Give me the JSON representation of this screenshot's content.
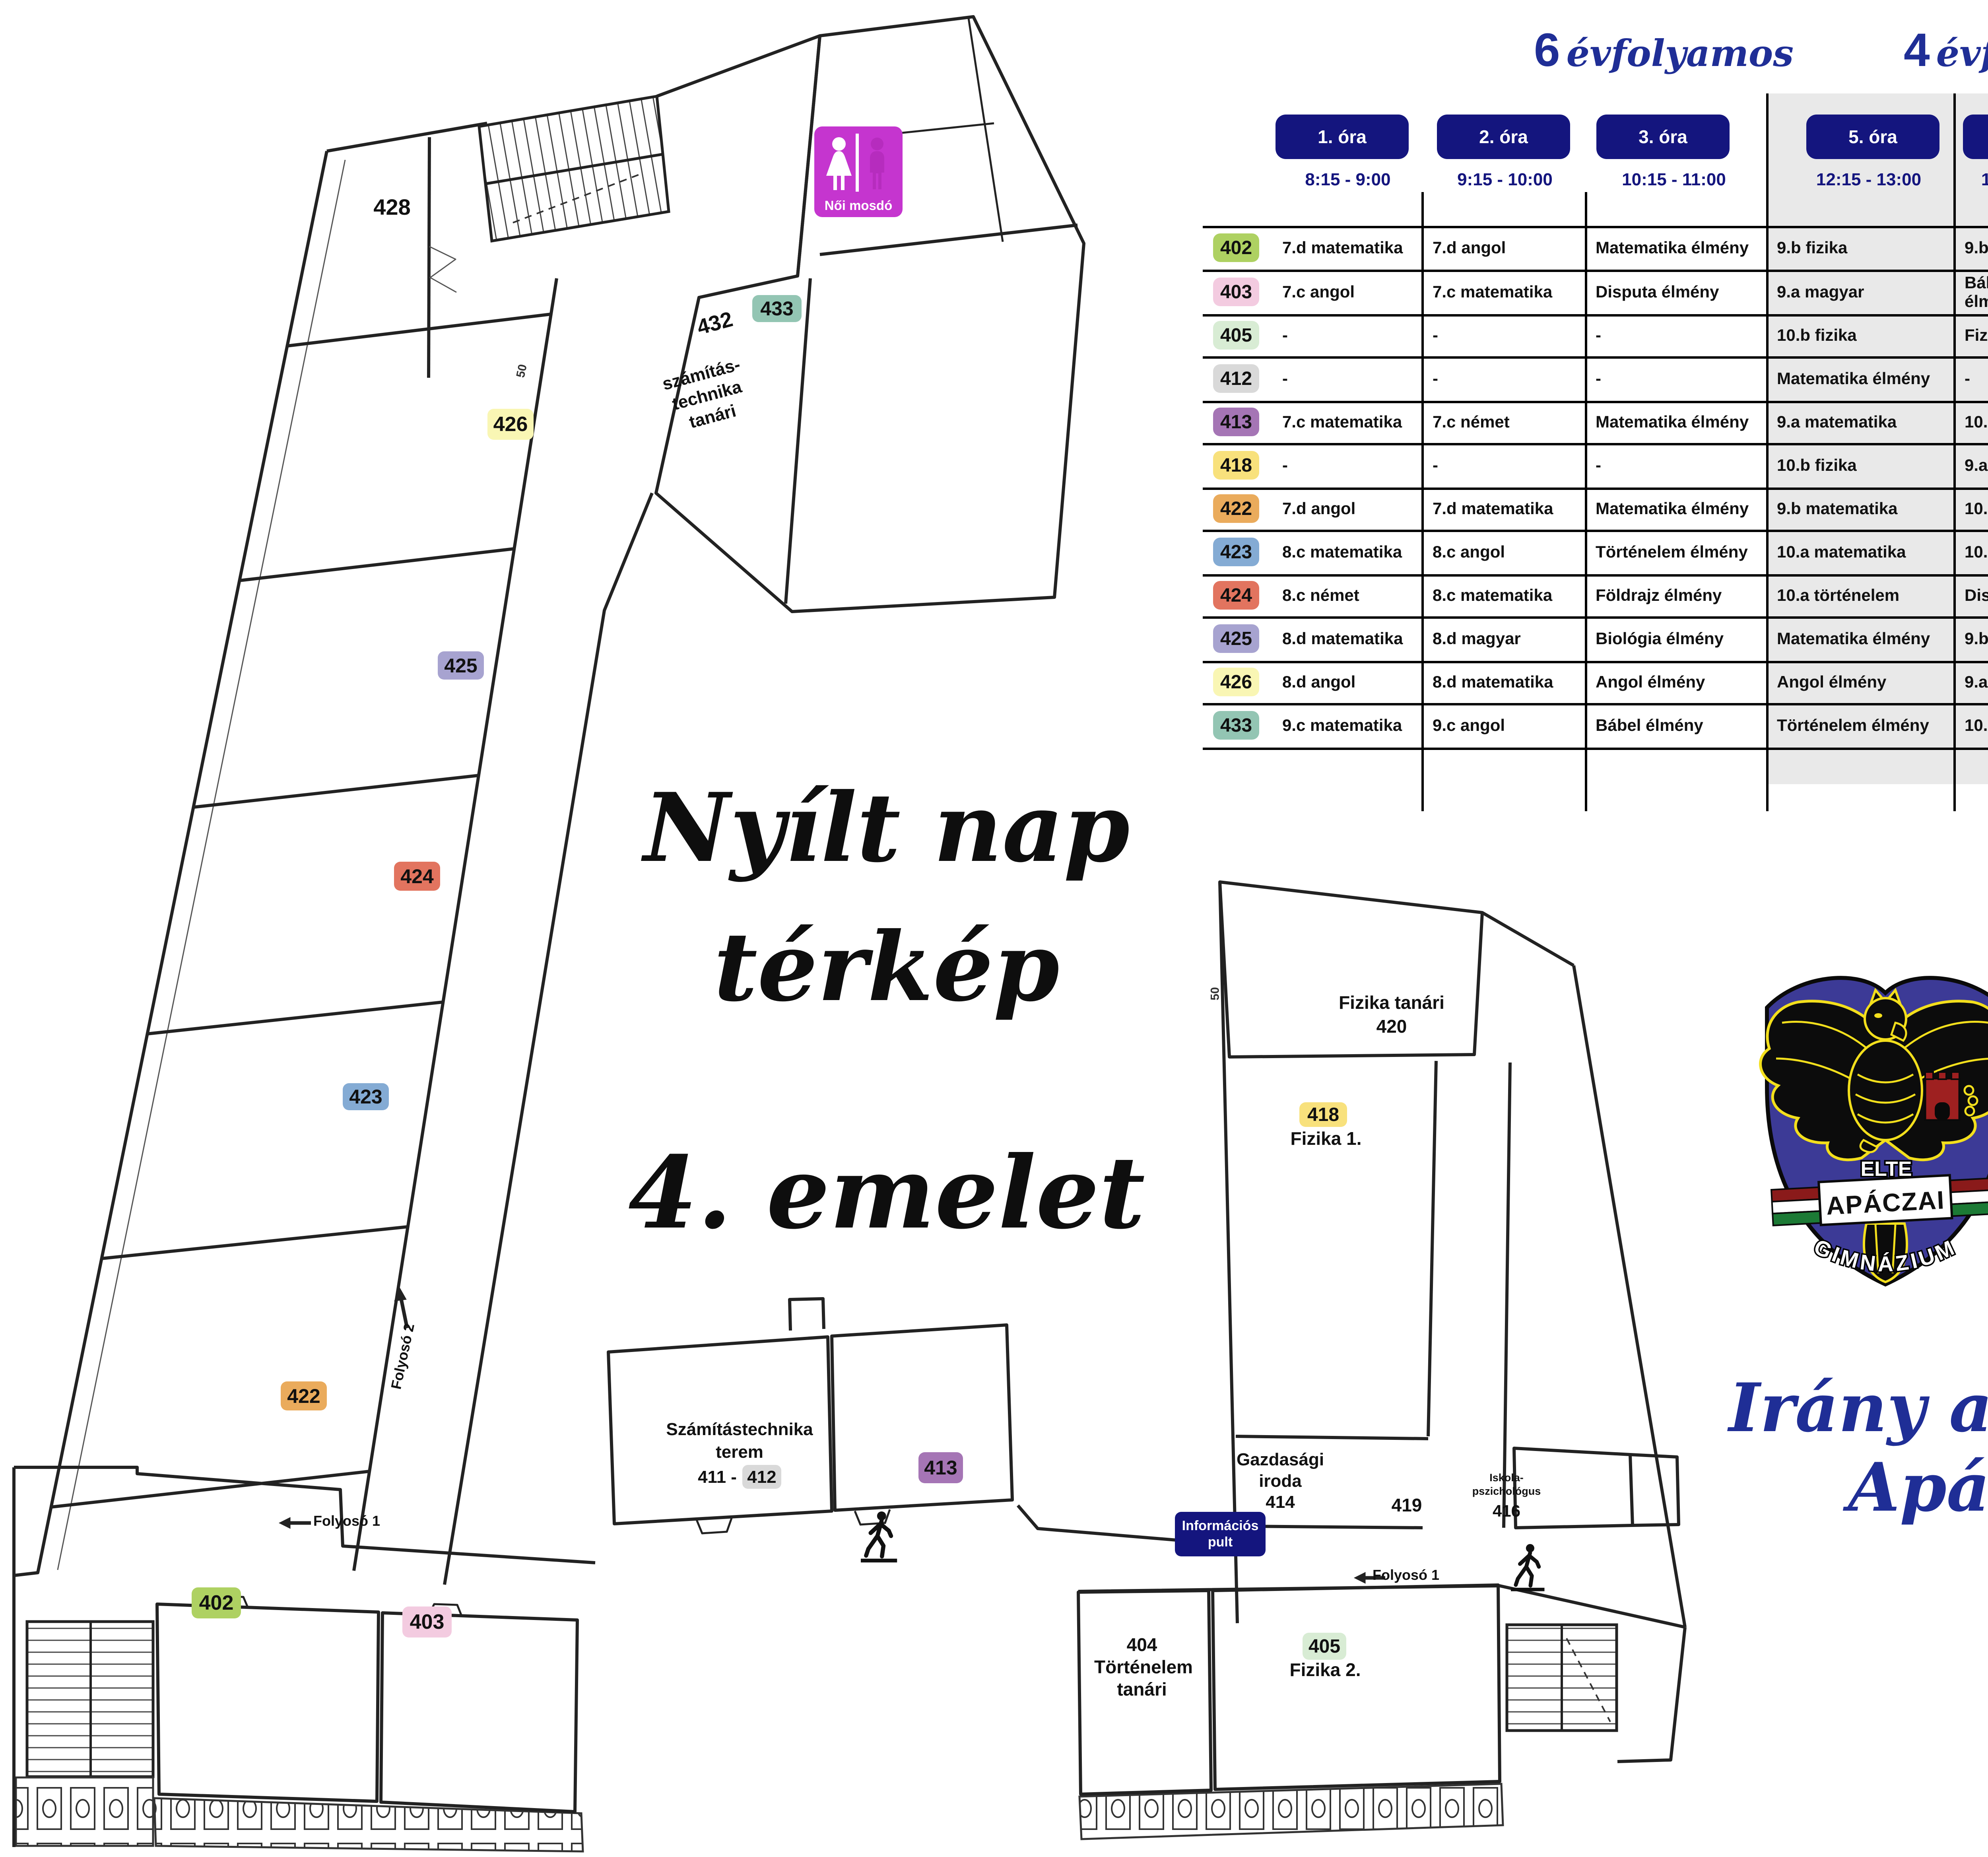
{
  "titles": {
    "line1": "Nyílt nap",
    "line2": "térkép",
    "floor": "4. emelet"
  },
  "slogan": {
    "line1": "Irány az",
    "line2": "Apáczai!"
  },
  "group_headers": {
    "left_num": "6",
    "left_label": "évfolyamos",
    "right_num": "4",
    "right_label": "évfolyamos"
  },
  "schedule": {
    "columns": [
      {
        "label": "1. óra",
        "time": "8:15 - 9:00"
      },
      {
        "label": "2. óra",
        "time": "9:15 - 10:00"
      },
      {
        "label": "3. óra",
        "time": "10:15 - 11:00"
      },
      {
        "label": "5. óra",
        "time": "12:15 - 13:00"
      },
      {
        "label": "6. óra",
        "time": "13:15 - 14:00"
      }
    ],
    "rows": [
      {
        "room": "402",
        "color": "#aed162",
        "cells": [
          "7.d matematika",
          "7.d angol",
          "Matematika élmény",
          "9.b fizika",
          "9.b matematika"
        ]
      },
      {
        "room": "403",
        "color": "#f3cbe0",
        "cells": [
          "7.c angol",
          "7.c matematika",
          "Disputa élmény",
          "9.a magyar",
          "Bábeli nyelvzavar élmény"
        ]
      },
      {
        "room": "405",
        "color": "#d8ecd4",
        "cells": [
          "-",
          "-",
          "-",
          "10.b fizika",
          "Fizika élmény"
        ]
      },
      {
        "room": "412",
        "color": "#d9d9d9",
        "cells": [
          "-",
          "-",
          "-",
          "Matematika élmény",
          "-"
        ]
      },
      {
        "room": "413",
        "color": "#a575b5",
        "cells": [
          "7.c matematika",
          "7.c német",
          "Matematika élmény",
          "9.a matematika",
          "10.a fizika"
        ]
      },
      {
        "room": "418",
        "color": "#f8e17c",
        "cells": [
          "-",
          "-",
          "-",
          "10.b fizika",
          "9.a fizika"
        ]
      },
      {
        "room": "422",
        "color": "#eaab5c",
        "cells": [
          "7.d angol",
          "7.d matematika",
          "Matematika élmény",
          "9.b matematika",
          "10.b földrajz"
        ]
      },
      {
        "room": "423",
        "color": "#84abd4",
        "cells": [
          "8.c matematika",
          "8.c angol",
          "Történelem élmény",
          "10.a matematika",
          "10.b matematika"
        ]
      },
      {
        "room": "424",
        "color": "#e2745f",
        "cells": [
          "8.c német",
          "8.c matematika",
          "Földrajz élmény",
          "10.a történelem",
          "Disputa élmény"
        ]
      },
      {
        "room": "425",
        "color": "#a7a3d0",
        "cells": [
          "8.d matematika",
          "8.d magyar",
          "Biológia élmény",
          "Matematika élmény",
          "9.b biológia"
        ]
      },
      {
        "room": "426",
        "color": "#f9f6b4",
        "cells": [
          "8.d angol",
          "8.d matematika",
          "Angol élmény",
          "Angol élmény",
          "9.a történelem"
        ]
      },
      {
        "room": "433",
        "color": "#93c5b3",
        "cells": [
          "9.c matematika",
          "9.c angol",
          "Bábel élmény",
          "Történelem élmény",
          "10.a magyar"
        ]
      }
    ]
  },
  "map": {
    "room428": "428",
    "room432": "432",
    "szt_tanari": [
      "számítás-",
      "technika",
      "tanári"
    ],
    "szamtech": [
      "Számítástechnika",
      "terem"
    ],
    "szamtech_prefix": "411 -",
    "fizika_tanari": "Fizika tanári",
    "room420": "420",
    "fizika1": "Fizika 1.",
    "fizika2": "Fizika 2.",
    "gazdasagi": [
      "Gazdasági",
      "iroda",
      "414"
    ],
    "room419": "419",
    "iskola": [
      "Iskola-",
      "pszichológus",
      "416"
    ],
    "room404": [
      "404",
      "Történelem",
      "tanári"
    ],
    "folyoso1": "Folyosó 1",
    "folyoso2": "Folyosó 2",
    "dim50": "50"
  },
  "signs": {
    "noi_mosdo": "Női mosdó",
    "info": [
      "Információs",
      "pult"
    ]
  },
  "logo": {
    "elte": "ELTE",
    "apaczai": "APÁCZAI",
    "gimnazium": "GIMNÁZIUM",
    "shield_color": "#3c3a96",
    "gold": "#f3df1c",
    "castle_color": "#9e2020",
    "tri_red": "#8a1a1a",
    "tri_green": "#1c7a35"
  },
  "colors": {
    "navy": "#14157e",
    "magenta": "#c535cf",
    "gray_block": "#e9e9e9",
    "script_blue": "#1f2e96",
    "wall": "#222222"
  }
}
